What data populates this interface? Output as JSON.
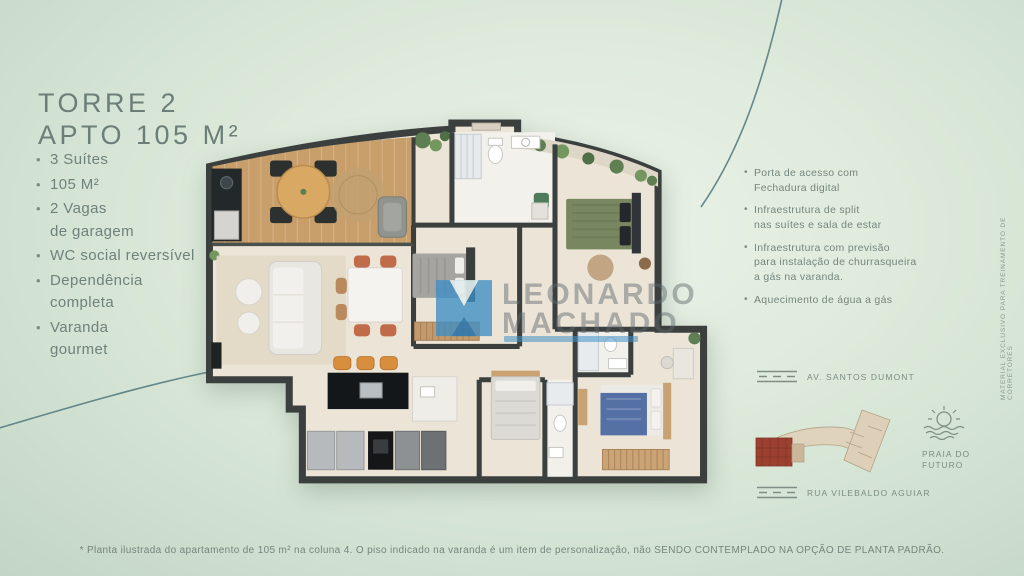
{
  "header": {
    "title_line1": "TORRE 2",
    "title_line2": "APTO 105 M²"
  },
  "features_left": {
    "items": [
      "3 Suítes",
      "105 M²",
      "2 Vagas\nde garagem",
      "WC social reversível",
      "Dependência\ncompleta",
      "Varanda\ngourmet"
    ]
  },
  "features_right": {
    "items": [
      "Porta de acesso com\nFechadura digital",
      "Infraestrutura de split\nnas suítes e sala de estar",
      "Infraestrutura com previsão\npara instalação de churrasqueira\na gás na varanda.",
      "Aquecimento de água a gás"
    ]
  },
  "watermark": {
    "line1": "LEONARDO",
    "line2": "MACHADO"
  },
  "site_map": {
    "road_top": "AV. SANTOS DUMONT",
    "road_bottom": "RUA VILEBALDO AGUIAR",
    "beach": "PRAIA DO\nFUTURO"
  },
  "side_note": {
    "text": "MATERIAL EXCLUSIVO PARA TREINAMENTO DE CORRETORES"
  },
  "footer": {
    "disclaimer": "* Planta ilustrada do apartamento de 105 m² na coluna 4. O piso indicado na varanda é um item de personalização, não SENDO CONTEMPLADO NA OPÇÃO DE PLANTA PADRÃO."
  },
  "colors": {
    "background": "#dcead9",
    "text": "#6f817b",
    "arc": "#4d757c",
    "walls": "#3b403f",
    "wood_floor": "#c89e6a",
    "watermark_blue": "#3d8ec6",
    "site_highlight": "#9c4130"
  }
}
